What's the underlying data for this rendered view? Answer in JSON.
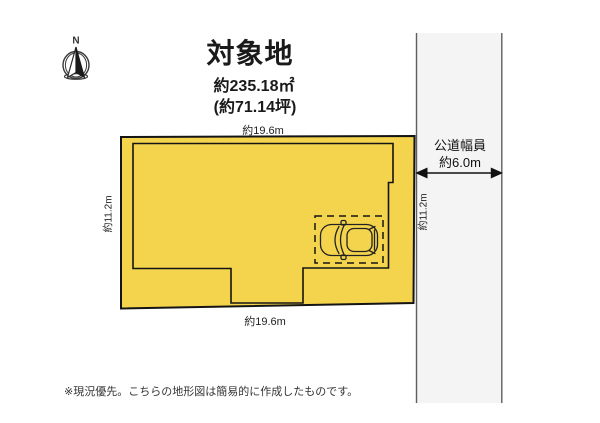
{
  "title": {
    "name": "対象地",
    "area_m2": "約235.18㎡",
    "area_tsubo": "(約71.14坪)"
  },
  "compass": {
    "north_label": "N"
  },
  "plot": {
    "top_dim": "約19.6m",
    "bottom_dim": "約19.6m",
    "left_dim": "約11.2m",
    "right_dim": "約11.2m"
  },
  "road": {
    "label_line1": "公道幅員",
    "label_line2": "約6.0m"
  },
  "footnote": "※現況優先。こちらの地形図は簡易的に作成したものです。",
  "colors": {
    "plot_fill": "#F4D44D",
    "road_fill": "#F4F4F4",
    "outline": "#141414",
    "road_border": "#5F5F5F"
  }
}
